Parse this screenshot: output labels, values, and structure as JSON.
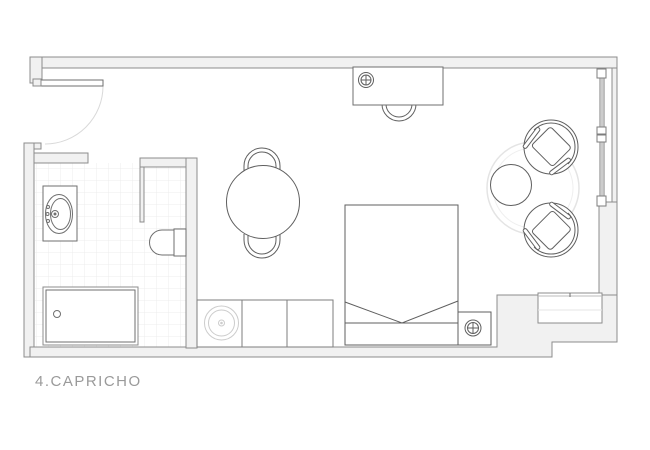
{
  "plan": {
    "label": "4.CAPRICHO",
    "type": "studio apartment floor plan",
    "depicted_elements": [
      "entrance door with swing arc",
      "bathroom with tiled floor",
      "washbasin vanity",
      "toilet",
      "shower tray with drain",
      "kitchenette counter with round sink",
      "round dining table with two chairs",
      "desk with chair and socket symbol",
      "double bed with blanket fold",
      "nightstand with socket symbol",
      "two round armchairs",
      "round side table",
      "circular rug",
      "full-height window",
      "built-in console cabinet"
    ]
  },
  "symbols": {
    "socket_symbol": "circle with cross (electrical/light point)",
    "drain_symbol": "small circle",
    "window_symbol": "double glazing lines with frame blocks"
  },
  "colors": {
    "background": "#ffffff",
    "wall_fill": "#f1f1f1",
    "wall_stroke": "#8c8c8c",
    "furniture_stroke": "#5f5f5f",
    "faint_line": "#d9d9d9",
    "tile_line": "#ececec",
    "label_text": "#9a9a9a"
  }
}
